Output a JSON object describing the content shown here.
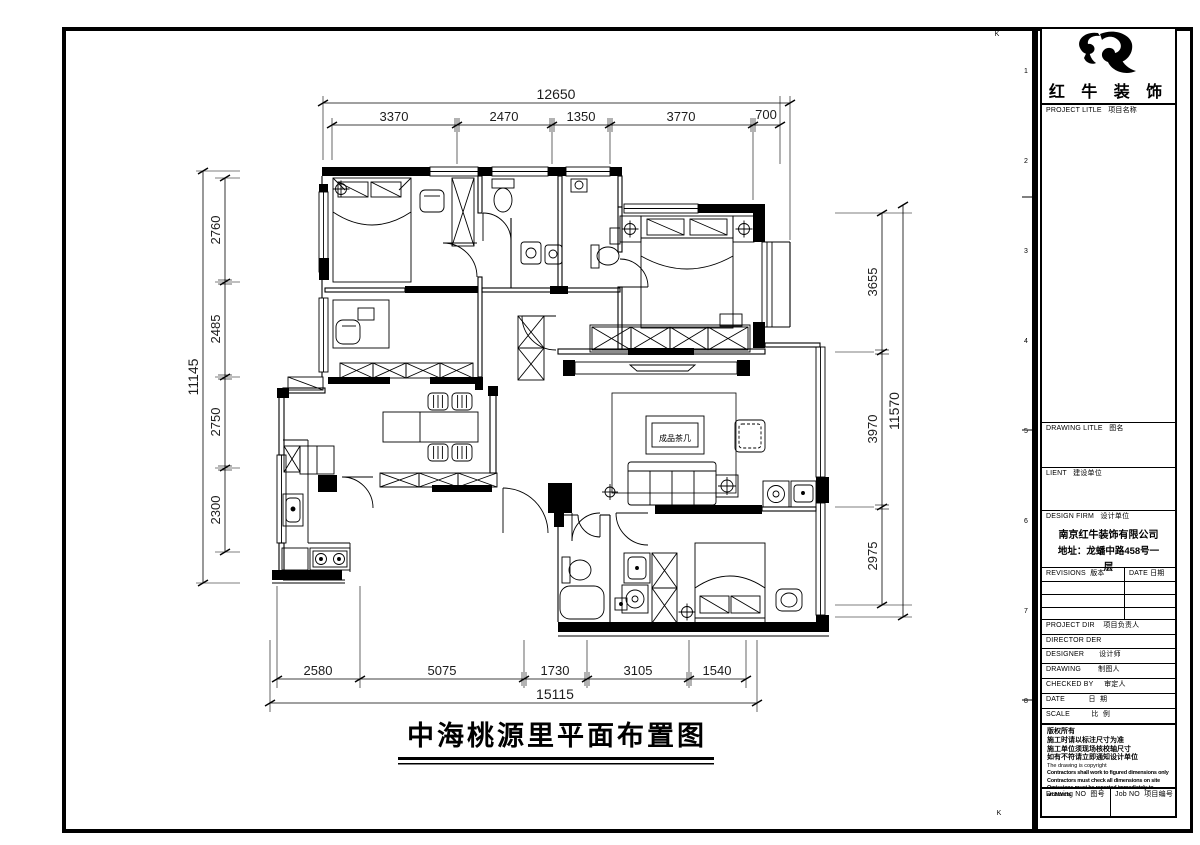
{
  "sheet": {
    "plan_title": "中海桃源里平面布置图",
    "zone_numbers": [
      "1",
      "2",
      "3",
      "4",
      "5",
      "6",
      "7",
      "8"
    ],
    "corner_mark_top": "K",
    "corner_mark_bottom": "K"
  },
  "plan": {
    "labels": {
      "coffee_table": "成品茶几"
    },
    "dims": {
      "top_total": "12650",
      "top_segments": [
        "3370",
        "2470",
        "1350",
        "3770",
        "700"
      ],
      "left_total": "11145",
      "left_segments": [
        "2760",
        "2485",
        "2750",
        "2300"
      ],
      "right_total": "11570",
      "right_segments": [
        "3655",
        "3970",
        "2975"
      ],
      "bottom_total": "15115",
      "bottom_segments": [
        "2580",
        "5075",
        "1730",
        "3105",
        "1540"
      ]
    }
  },
  "titleblock": {
    "brand_name": "红 牛 装 饰",
    "project_title_label": "PROJECT LITLE   项目名称",
    "drawing_title_label": "DRAWING LITLE   图名",
    "client_label": "LIENT   建设单位",
    "design_firm_label": "DESIGN FIRM   设计单位",
    "firm_name": "南京红牛装饰有限公司",
    "firm_address_line1": "地址：龙蟠中路458号一",
    "firm_address_line2": "层",
    "revisions_label": "REVISIONS  版本",
    "revision_date_label": "DATE 日期",
    "project_dir_label": "PROJECT DIR    项目负责人",
    "director_label": "DIRECTOR DER",
    "designer_label": "DESIGNER       设计师",
    "drawing_by_label": "DRAWING        制图人",
    "checked_by_label": "CHECKED BY     审定人",
    "date_label": "DATE           日  期",
    "scale_label": "SCALE          比  例",
    "notes": [
      "版权所有",
      "施工时请以标注尺寸为准",
      "施工单位须现场核校轴尺寸",
      "如有不符请立即通知设计单位",
      "The drawing is copyright",
      "Contractors shall work to figured dimensions only",
      "Contractors must check all dimensions on site",
      "Omissions must be reported immediately to architects"
    ],
    "drawing_no_label": "Drawing NO  图号",
    "job_no_label": "Job NO  项目编号"
  }
}
